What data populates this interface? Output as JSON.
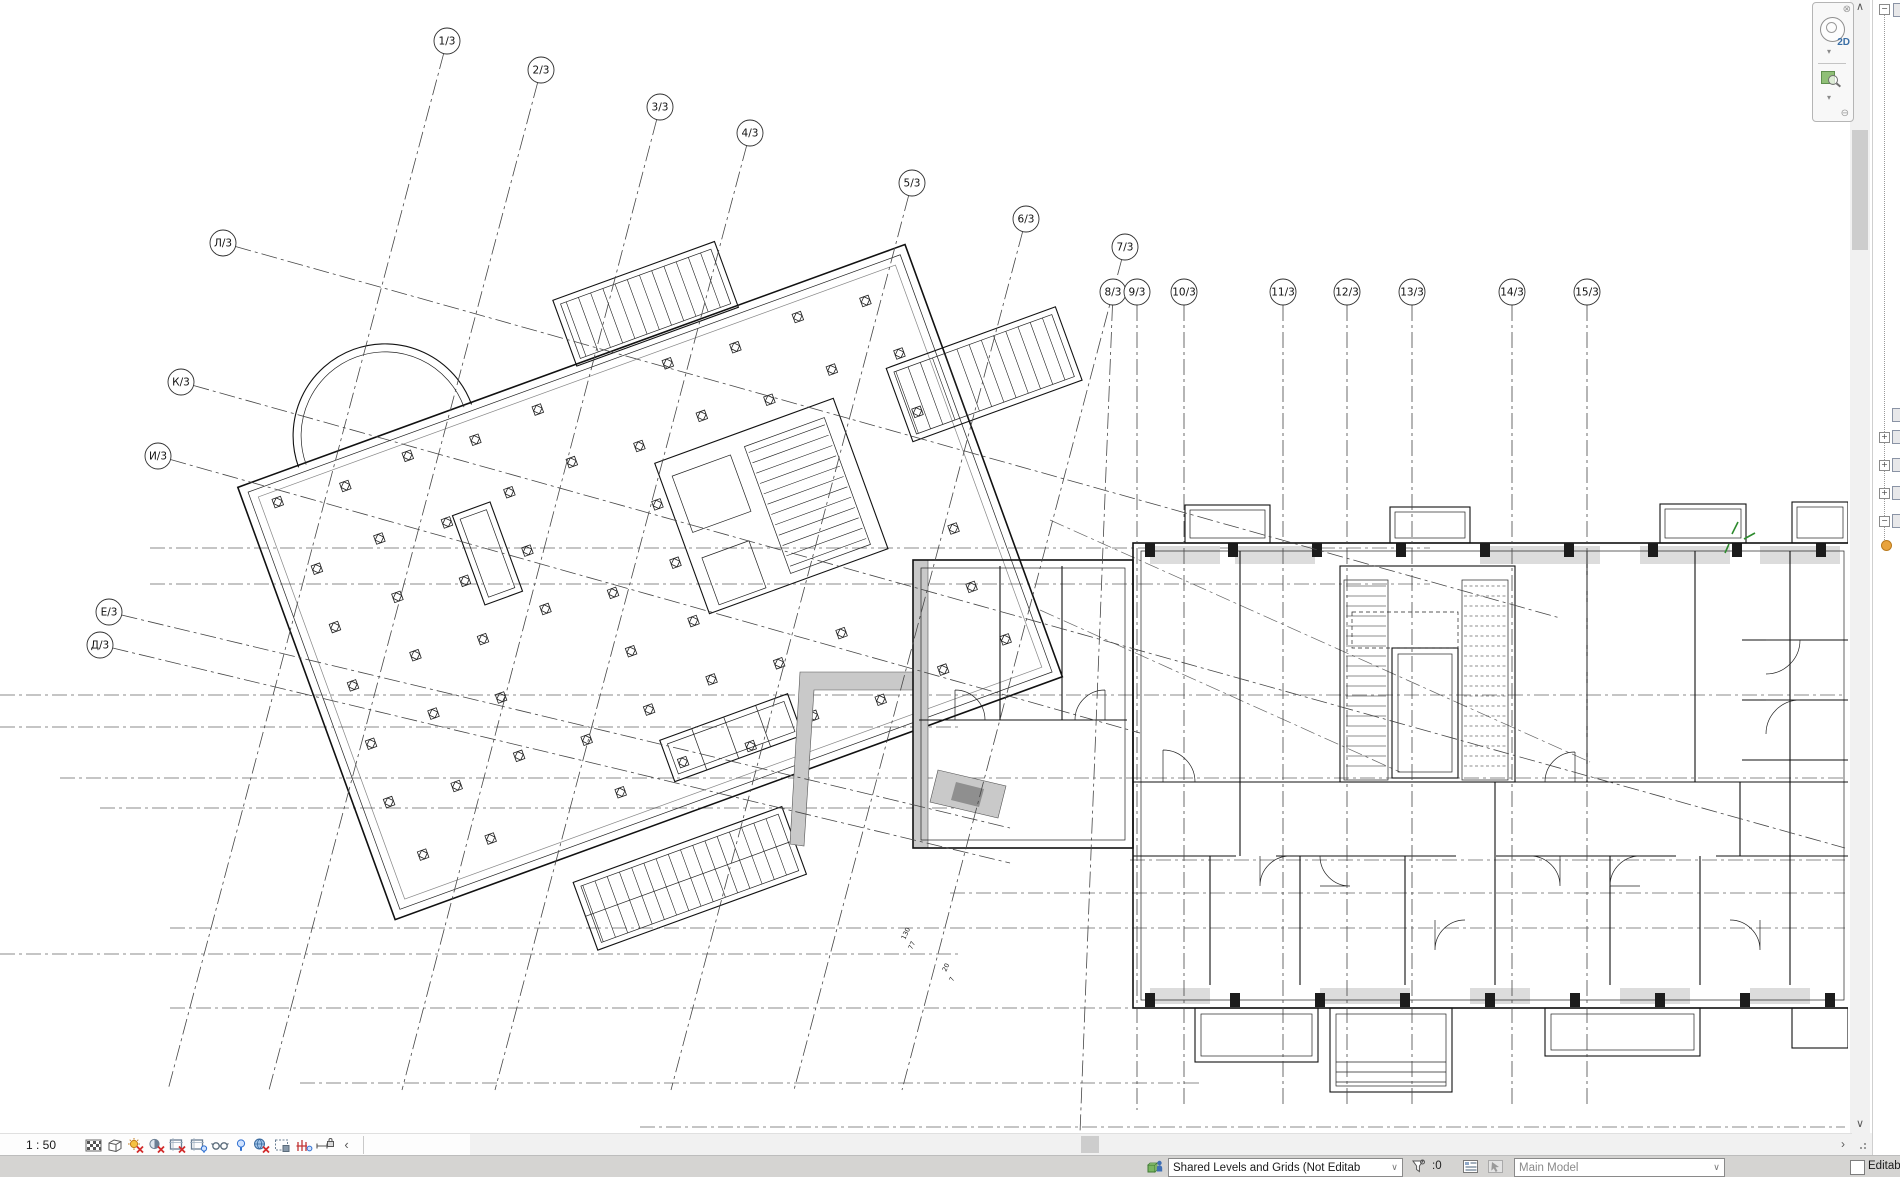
{
  "view_control_bar": {
    "scale_label": "1 : 50",
    "icons": [
      "detail-level",
      "visual-style",
      "sun-path-off",
      "shadows-off",
      "crop-view-off",
      "show-crop-region",
      "temporary-hide-isolate",
      "reveal-hidden-elements",
      "worksharing-display-off",
      "temporary-view-properties",
      "analytical-model",
      "reveal-constraints",
      "collapse-arrow"
    ],
    "collapse_glyph": "‹"
  },
  "scrollbars": {
    "up_glyph": "∧",
    "down_glyph": "∨",
    "right_glyph": "›"
  },
  "navigation_bar": {
    "close_glyph": "⊗",
    "wheel_label": "2D",
    "caret_glyph": "▾",
    "minimize_glyph": "⊖"
  },
  "status_bar": {
    "active_workset": "Shared Levels and Grids (Not Editab",
    "selection_count": ":0",
    "active_design_option": "Main Model",
    "editable_only_label": "Editab",
    "combo_arrow_glyph": "∨"
  },
  "project_browser_strip": {
    "collapse_glyph": "−",
    "expand_glyph": "+"
  },
  "grids": {
    "numbered": [
      {
        "label": "1/3",
        "bx": 447,
        "by": 41,
        "x2": 168,
        "y2": 1090
      },
      {
        "label": "2/3",
        "bx": 541,
        "by": 70,
        "x2": 269,
        "y2": 1090
      },
      {
        "label": "3/3",
        "bx": 660,
        "by": 107,
        "x2": 402,
        "y2": 1090
      },
      {
        "label": "4/3",
        "bx": 750,
        "by": 133,
        "x2": 495,
        "y2": 1090
      },
      {
        "label": "5/3",
        "bx": 912,
        "by": 183,
        "x2": 671,
        "y2": 1090
      },
      {
        "label": "6/3",
        "bx": 1026,
        "by": 219,
        "x2": 794,
        "y2": 1090
      },
      {
        "label": "7/3",
        "bx": 1125,
        "by": 247,
        "x2": 902,
        "y2": 1090
      },
      {
        "label": "8/3",
        "bx": 1113,
        "by": 292,
        "x2": 1080,
        "y2": 1133
      },
      {
        "label": "9/3",
        "bx": 1137,
        "by": 292,
        "x2": 1137,
        "y2": 1110
      }
    ],
    "vertical": [
      {
        "label": "10/3",
        "bx": 1184,
        "by": 292,
        "x2": 1184,
        "y2": 1105
      },
      {
        "label": "11/3",
        "bx": 1283,
        "by": 292,
        "x2": 1283,
        "y2": 1105
      },
      {
        "label": "12/3",
        "bx": 1347,
        "by": 292,
        "x2": 1347,
        "y2": 1105
      },
      {
        "label": "13/3",
        "bx": 1412,
        "by": 292,
        "x2": 1412,
        "y2": 1105
      },
      {
        "label": "14/3",
        "bx": 1512,
        "by": 292,
        "x2": 1512,
        "y2": 1105
      },
      {
        "label": "15/3",
        "bx": 1587,
        "by": 292,
        "x2": 1587,
        "y2": 1105
      }
    ],
    "lettered": [
      {
        "label": "Л/3",
        "bx": 223,
        "by": 243,
        "x2": 1560,
        "y2": 618
      },
      {
        "label": "К/3",
        "bx": 181,
        "by": 382,
        "x2": 1845,
        "y2": 848
      },
      {
        "label": "И/3",
        "bx": 158,
        "by": 456,
        "x2": 1140,
        "y2": 733
      },
      {
        "label": "Е/3",
        "bx": 109,
        "by": 612,
        "x2": 1010,
        "y2": 828
      },
      {
        "label": "Д/3",
        "bx": 100,
        "by": 645,
        "x2": 1010,
        "y2": 863
      }
    ]
  },
  "annotations": {
    "small": [
      {
        "text": "130"
      },
      {
        "text": "77"
      },
      {
        "text": "20"
      },
      {
        "text": "7"
      }
    ]
  },
  "colors": {
    "accent_green": "#2e8b2e",
    "sun_yellow": "#f5c242",
    "error_red": "#d22b2b",
    "revit_blue": "#2e6fd0",
    "workset_green": "#7ab661"
  }
}
